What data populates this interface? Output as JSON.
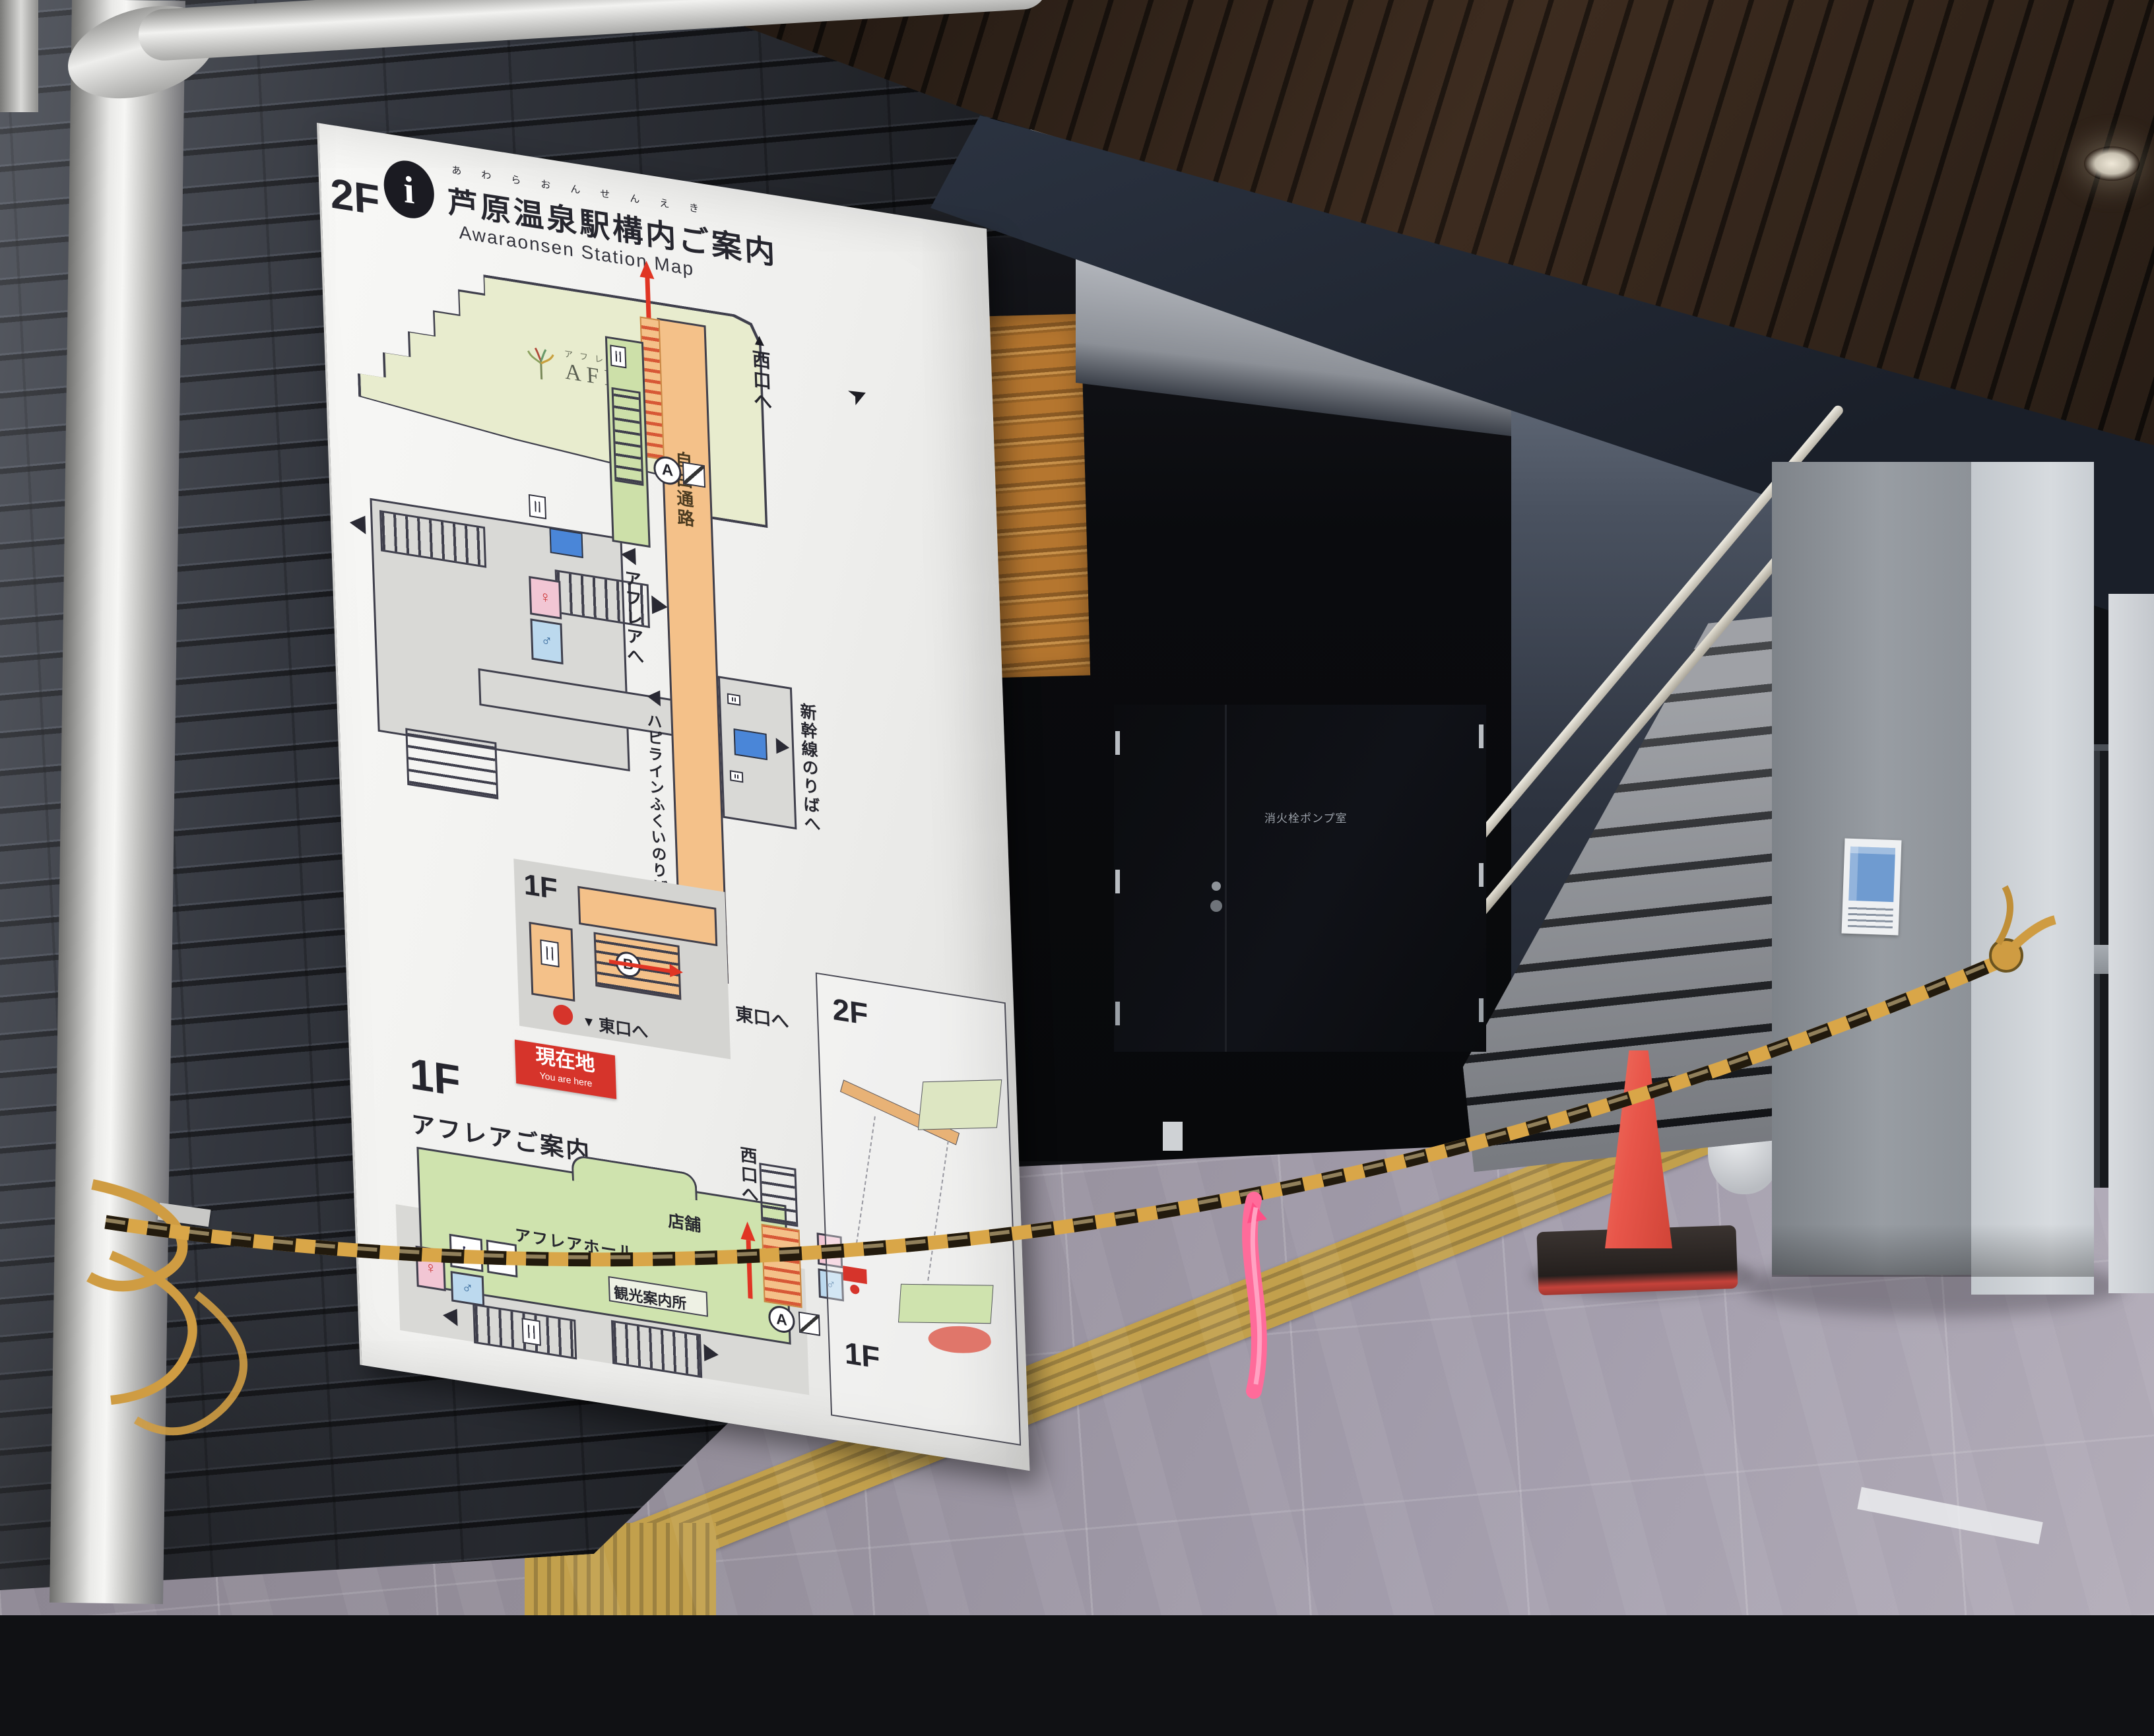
{
  "sign": {
    "info_icon": "i",
    "title_furigana": "あわらおんせんえき",
    "title": "芦原温泉駅構内ご案内",
    "subtitle": "Awaraonsen Station Map",
    "floor2": {
      "label": "2F",
      "aflare_furigana": "アフレア",
      "aflare_name": "AFLARE",
      "to_west_exit": "西口へ",
      "to_aflare": "アフレアへ",
      "free_passage": "自由通路",
      "to_hapiline": "ハピラインふくいのりばへ",
      "to_shinkansen": "新幹線のりばへ",
      "to_east_exit": "東口へ",
      "inset_floor_label": "1F",
      "circle_a": "A",
      "circle_b": "B",
      "you_are_here_jp": "現在地",
      "you_are_here_en": "You are here"
    },
    "floor1": {
      "label": "1F",
      "heading": "アフレアご案内",
      "shops": "店舗",
      "hall": "アフレアホール",
      "tourist_info": "観光案内所",
      "to_west_exit": "西口へ",
      "circle_a": "A"
    },
    "overview_inset": {
      "floor2_label": "2F",
      "floor1_label": "1F"
    }
  },
  "scene": {
    "door_label": "消火栓ポンプ室"
  },
  "icons": {
    "female": "♀",
    "male": "♂",
    "wheelchair": "♿",
    "triangle_up": "▲",
    "triangle_down": "▼",
    "compass": "➤"
  },
  "colors": {
    "rope": "#d9a648",
    "cone": "#e8564a",
    "corridor_orange": "#f4c189",
    "aflare_area": "#e8ecce",
    "floor1_green": "#cfe3ae",
    "badge_red": "#d6342b",
    "map_blue": "#4a86d8"
  }
}
